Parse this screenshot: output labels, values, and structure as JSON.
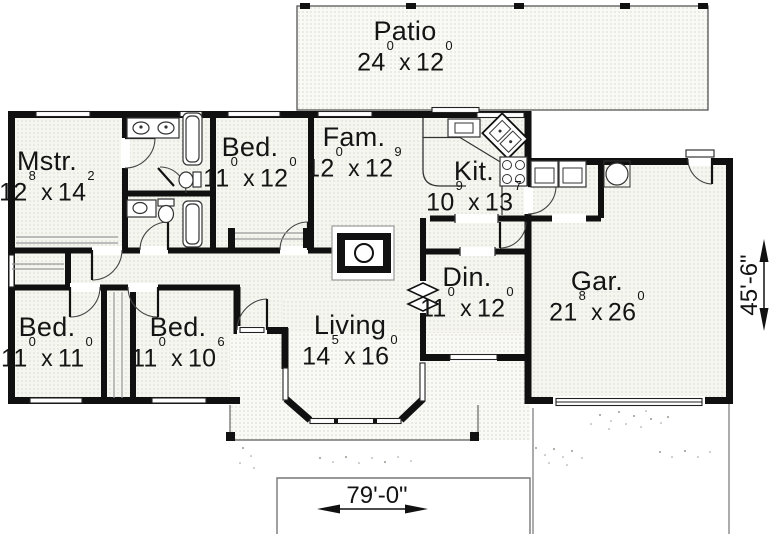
{
  "rooms": {
    "patio": {
      "name": "Patio",
      "dim": {
        "a": "24",
        "a_sup": "0",
        "b": "12",
        "b_sup": "0"
      }
    },
    "mstr": {
      "name": "Mstr.",
      "dim": {
        "a": "12",
        "a_sup": "8",
        "b": "14",
        "b_sup": "2"
      }
    },
    "bed_top": {
      "name": "Bed.",
      "dim": {
        "a": "11",
        "a_sup": "0",
        "b": "12",
        "b_sup": "0"
      }
    },
    "fam": {
      "name": "Fam.",
      "dim": {
        "a": "12",
        "a_sup": "0",
        "b": "12",
        "b_sup": "9"
      }
    },
    "kit": {
      "name": "Kit.",
      "dim": {
        "a": "10",
        "a_sup": "9",
        "b": "13",
        "b_sup": "7"
      }
    },
    "din": {
      "name": "Din.",
      "dim": {
        "a": "11",
        "a_sup": "0",
        "b": "12",
        "b_sup": "0"
      }
    },
    "gar": {
      "name": "Gar.",
      "dim": {
        "a": "21",
        "a_sup": "8",
        "b": "26",
        "b_sup": "0"
      }
    },
    "bed_left": {
      "name": "Bed.",
      "dim": {
        "a": "11",
        "a_sup": "0",
        "b": "11",
        "b_sup": "0"
      }
    },
    "bed_mid": {
      "name": "Bed.",
      "dim": {
        "a": "11",
        "a_sup": "0",
        "b": "10",
        "b_sup": "6"
      }
    },
    "living": {
      "name": "Living",
      "dim": {
        "a": "14",
        "a_sup": "5",
        "b": "16",
        "b_sup": "0"
      }
    }
  },
  "glyphs": {
    "times": "x"
  },
  "overall_dimensions": {
    "width": "79'-0\"",
    "height": "45'-6\""
  }
}
